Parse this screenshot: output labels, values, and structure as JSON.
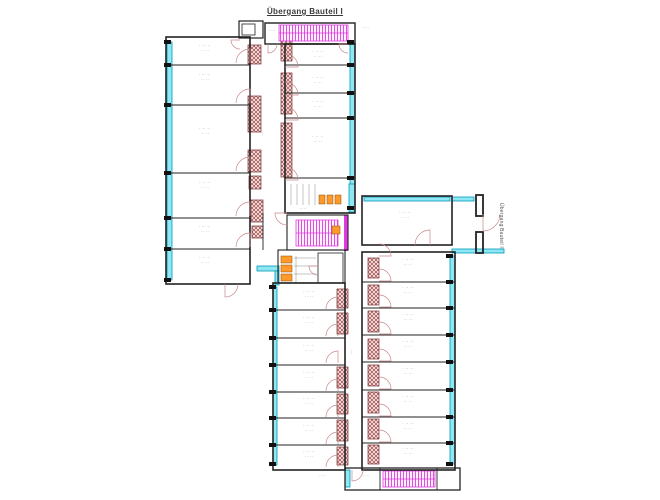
{
  "labels": {
    "title": "Übergang Bauteil I",
    "side_label": "Übergang Bauteil II",
    "room_line1": "· ·· ··",
    "room_line2": "·· ··",
    "corridor": "····"
  },
  "colors": {
    "wall": "#222222",
    "glazing_fill": "#8ee7f2",
    "glazing_stroke": "#0099bb",
    "pier_bg": "#f6eaea",
    "pier_line": "#a04545",
    "pier_stroke": "#7a2e2e",
    "stair_bg": "#fdf0fd",
    "stair_line": "#e23ae2",
    "fixture_fill": "#ff9a2a",
    "fixture_stroke": "#8a4a00",
    "door": "#c88888",
    "stall": "#8a8a8a",
    "text": "#707070",
    "tick": "#111111"
  },
  "floorplan": {
    "walls": [
      [
        239,
        21,
        24,
        17,
        1.2
      ],
      [
        242,
        24,
        13,
        11,
        0.8
      ],
      [
        265,
        23,
        90,
        21,
        1.4
      ],
      [
        166,
        37,
        84,
        247,
        1.6
      ],
      [
        285,
        44,
        70,
        169,
        1.6
      ],
      [
        287,
        215,
        61,
        35,
        1.1
      ],
      [
        278,
        250,
        67,
        33,
        1.1
      ],
      [
        318,
        253,
        25,
        30,
        0.8
      ],
      [
        362,
        196,
        90,
        49,
        1.6
      ],
      [
        362,
        252,
        93,
        218,
        1.6
      ],
      [
        273,
        283,
        72,
        187,
        1.6
      ],
      [
        345,
        468,
        115,
        22,
        1.3
      ],
      [
        476,
        195,
        7,
        21,
        1.8
      ],
      [
        476,
        232,
        7,
        21,
        1.8
      ]
    ],
    "lines": [
      [
        166,
        65,
        250,
        65
      ],
      [
        166,
        105,
        250,
        105
      ],
      [
        166,
        173,
        250,
        173
      ],
      [
        166,
        218,
        250,
        218
      ],
      [
        166,
        249,
        250,
        249
      ],
      [
        285,
        65,
        355,
        65
      ],
      [
        285,
        93,
        355,
        93
      ],
      [
        285,
        118,
        355,
        118
      ],
      [
        285,
        178,
        355,
        178
      ],
      [
        273,
        310,
        345,
        310
      ],
      [
        273,
        338,
        345,
        338
      ],
      [
        273,
        365,
        345,
        365
      ],
      [
        273,
        392,
        345,
        392
      ],
      [
        273,
        418,
        345,
        418
      ],
      [
        273,
        445,
        345,
        445
      ],
      [
        362,
        282,
        455,
        282
      ],
      [
        362,
        308,
        455,
        308
      ],
      [
        362,
        335,
        455,
        335
      ],
      [
        362,
        362,
        455,
        362
      ],
      [
        362,
        390,
        455,
        390
      ],
      [
        362,
        417,
        455,
        417
      ],
      [
        362,
        443,
        455,
        443
      ],
      [
        263,
        213,
        263,
        250
      ],
      [
        380,
        468,
        380,
        490
      ],
      [
        437,
        468,
        437,
        490
      ]
    ],
    "stalls": [
      [
        291,
        184,
        291,
        205
      ],
      [
        297,
        184,
        297,
        205
      ],
      [
        303,
        184,
        303,
        205
      ],
      [
        309,
        184,
        309,
        205
      ],
      [
        315,
        184,
        315,
        205
      ],
      [
        294,
        258,
        316,
        258
      ],
      [
        294,
        266,
        316,
        266
      ],
      [
        294,
        274,
        316,
        274
      ],
      [
        296,
        256,
        296,
        282
      ]
    ],
    "glazing": [
      [
        167,
        42,
        5,
        238
      ],
      [
        350,
        42,
        5,
        168
      ],
      [
        349,
        184,
        6,
        28
      ],
      [
        257,
        266,
        22,
        5
      ],
      [
        275,
        271,
        4,
        14
      ],
      [
        364,
        197,
        86,
        4
      ],
      [
        452,
        197,
        22,
        4
      ],
      [
        452,
        249,
        52,
        4
      ],
      [
        450,
        256,
        5,
        208
      ],
      [
        273,
        287,
        4,
        178
      ],
      [
        345,
        470,
        5,
        17
      ]
    ],
    "piers": [
      [
        248,
        45,
        13,
        19
      ],
      [
        248,
        96,
        13,
        36
      ],
      [
        248,
        150,
        13,
        22
      ],
      [
        249,
        176,
        12,
        13
      ],
      [
        251,
        200,
        12,
        22
      ],
      [
        252,
        226,
        11,
        12
      ],
      [
        281,
        40,
        11,
        21
      ],
      [
        281,
        73,
        11,
        41
      ],
      [
        281,
        123,
        11,
        54
      ],
      [
        337,
        289,
        11,
        19
      ],
      [
        337,
        313,
        11,
        21
      ],
      [
        337,
        367,
        11,
        21
      ],
      [
        337,
        394,
        11,
        20
      ],
      [
        337,
        420,
        11,
        21
      ],
      [
        337,
        447,
        11,
        18
      ],
      [
        368,
        258,
        11,
        20
      ],
      [
        368,
        285,
        11,
        20
      ],
      [
        368,
        311,
        11,
        21
      ],
      [
        368,
        339,
        11,
        20
      ],
      [
        368,
        365,
        11,
        21
      ],
      [
        368,
        392,
        11,
        21
      ],
      [
        368,
        419,
        11,
        20
      ],
      [
        368,
        445,
        11,
        19
      ]
    ],
    "stairs": [
      [
        279,
        25,
        69,
        16
      ],
      [
        296,
        220,
        42,
        26
      ],
      [
        383,
        471,
        52,
        16
      ]
    ],
    "stair_accents": [
      [
        344,
        215,
        4,
        36
      ]
    ],
    "fixtures": [
      [
        319,
        195,
        6,
        9
      ],
      [
        327,
        195,
        6,
        9
      ],
      [
        335,
        195,
        6,
        9
      ],
      [
        281,
        256,
        11,
        7
      ],
      [
        281,
        265,
        11,
        7
      ],
      [
        281,
        274,
        11,
        7
      ],
      [
        332,
        226,
        8,
        8
      ]
    ],
    "doors": [
      [
        250,
        63,
        14,
        180,
        270
      ],
      [
        250,
        103,
        14,
        180,
        270
      ],
      [
        250,
        171,
        14,
        180,
        270
      ],
      [
        250,
        216,
        14,
        180,
        270
      ],
      [
        250,
        247,
        14,
        180,
        270
      ],
      [
        225,
        284,
        13,
        0,
        90
      ],
      [
        285,
        67,
        13,
        270,
        360
      ],
      [
        285,
        95,
        13,
        270,
        360
      ],
      [
        285,
        120,
        13,
        270,
        360
      ],
      [
        285,
        180,
        13,
        270,
        360
      ],
      [
        287,
        213,
        12,
        90,
        180
      ],
      [
        318,
        266,
        9,
        90,
        180
      ],
      [
        430,
        245,
        15,
        180,
        270
      ],
      [
        483,
        214,
        17,
        0,
        90
      ],
      [
        338,
        309,
        12,
        180,
        270
      ],
      [
        338,
        336,
        12,
        180,
        270
      ],
      [
        338,
        363,
        12,
        180,
        270
      ],
      [
        338,
        391,
        12,
        180,
        270
      ],
      [
        338,
        417,
        12,
        180,
        270
      ],
      [
        338,
        444,
        12,
        180,
        270
      ],
      [
        338,
        467,
        12,
        180,
        270
      ],
      [
        379,
        256,
        12,
        270,
        360
      ],
      [
        379,
        281,
        12,
        270,
        360
      ],
      [
        379,
        307,
        12,
        270,
        360
      ],
      [
        379,
        334,
        12,
        270,
        360
      ],
      [
        379,
        361,
        12,
        270,
        360
      ],
      [
        379,
        389,
        12,
        270,
        360
      ],
      [
        379,
        416,
        12,
        270,
        360
      ],
      [
        379,
        442,
        12,
        270,
        360
      ],
      [
        352,
        470,
        11,
        0,
        90
      ],
      [
        268,
        44,
        9,
        0,
        90
      ],
      [
        348,
        44,
        9,
        90,
        180
      ],
      [
        240,
        40,
        9,
        90,
        180
      ]
    ],
    "tick_columns": [
      {
        "x": 164,
        "ys": [
          42,
          65,
          105,
          173,
          218,
          249,
          280
        ]
      },
      {
        "x": 347,
        "ys": [
          42,
          65,
          93,
          118,
          178,
          208
        ]
      },
      {
        "x": 269,
        "ys": [
          287,
          310,
          338,
          365,
          392,
          418,
          445,
          464
        ]
      },
      {
        "x": 446,
        "ys": [
          256,
          282,
          308,
          335,
          362,
          390,
          417,
          443,
          464
        ]
      }
    ],
    "room_labels": [
      [
        205,
        47
      ],
      [
        205,
        76
      ],
      [
        205,
        130
      ],
      [
        205,
        184
      ],
      [
        205,
        228
      ],
      [
        205,
        259
      ],
      [
        318,
        53
      ],
      [
        318,
        79
      ],
      [
        318,
        103
      ],
      [
        318,
        138
      ],
      [
        405,
        214
      ],
      [
        309,
        293
      ],
      [
        309,
        319
      ],
      [
        309,
        347
      ],
      [
        309,
        374
      ],
      [
        309,
        400
      ],
      [
        309,
        427
      ],
      [
        309,
        453
      ],
      [
        408,
        261
      ],
      [
        408,
        289
      ],
      [
        408,
        316
      ],
      [
        408,
        343
      ],
      [
        408,
        370
      ],
      [
        408,
        398
      ],
      [
        408,
        425
      ],
      [
        408,
        450
      ]
    ],
    "corridor_labels": [
      [
        264,
        133
      ],
      [
        353,
        352
      ]
    ],
    "misc_labels": [
      [
        366,
        29
      ],
      [
        272,
        32
      ],
      [
        366,
        477
      ],
      [
        331,
        247
      ],
      [
        303,
        210
      ],
      [
        322,
        477
      ],
      [
        430,
        477
      ]
    ]
  }
}
